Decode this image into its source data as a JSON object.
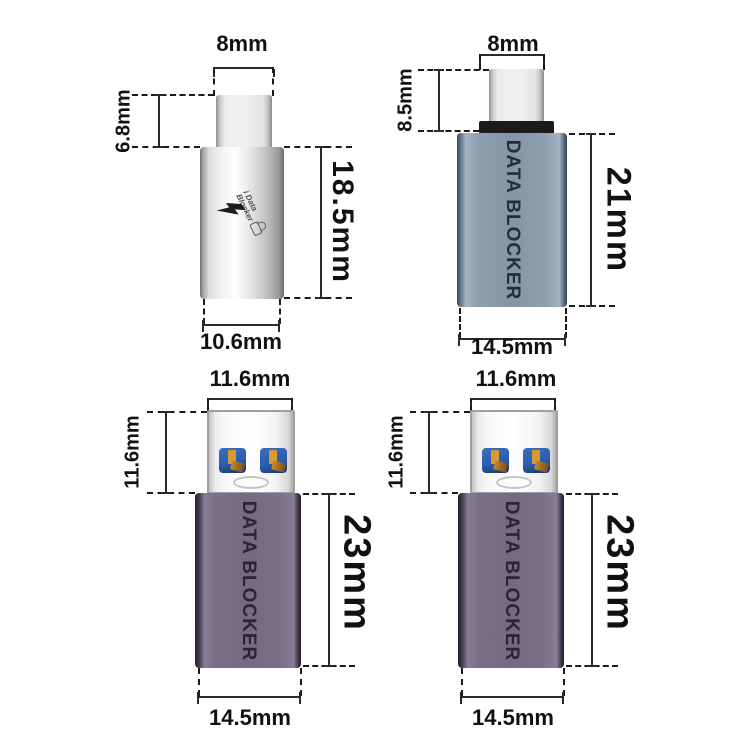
{
  "title": "USB data blocker adapters dimension diagram",
  "colors": {
    "background": "#ffffff",
    "dimension_lines": "#1a1a1a",
    "silver_body": "#e6e6e6",
    "gray_blue_body": "#8496a6",
    "purple_body": "#746a82",
    "collar_black": "#1b1b1b",
    "usb_tongue_blue": "#2d5dae",
    "usb_contact_gold": "#d89a33"
  },
  "units": [
    {
      "name": "USB-C coupler adapter, silver",
      "width_top": "8mm",
      "plug_height": "6.8mm",
      "body_height": "18.5mm",
      "width_bottom": "10.6mm",
      "logo_line1": "i Data",
      "logo_line2": "Blocker"
    },
    {
      "name": "USB-C male data blocker, gray-blue",
      "width_top": "8mm",
      "plug_height": "8.5mm",
      "body_height": "21mm",
      "width_bottom": "14.5mm",
      "body_text": "DATA BLOCKER"
    },
    {
      "name": "USB-A male data blocker, purple (left)",
      "width_top": "11.6mm",
      "plug_height": "11.6mm",
      "body_height": "23mm",
      "width_bottom": "14.5mm",
      "body_text": "DATA BLOCKER"
    },
    {
      "name": "USB-A male data blocker, purple (right)",
      "width_top": "11.6mm",
      "plug_height": "11.6mm",
      "body_height": "23mm",
      "width_bottom": "14.5mm",
      "body_text": "DATA BLOCKER"
    }
  ]
}
